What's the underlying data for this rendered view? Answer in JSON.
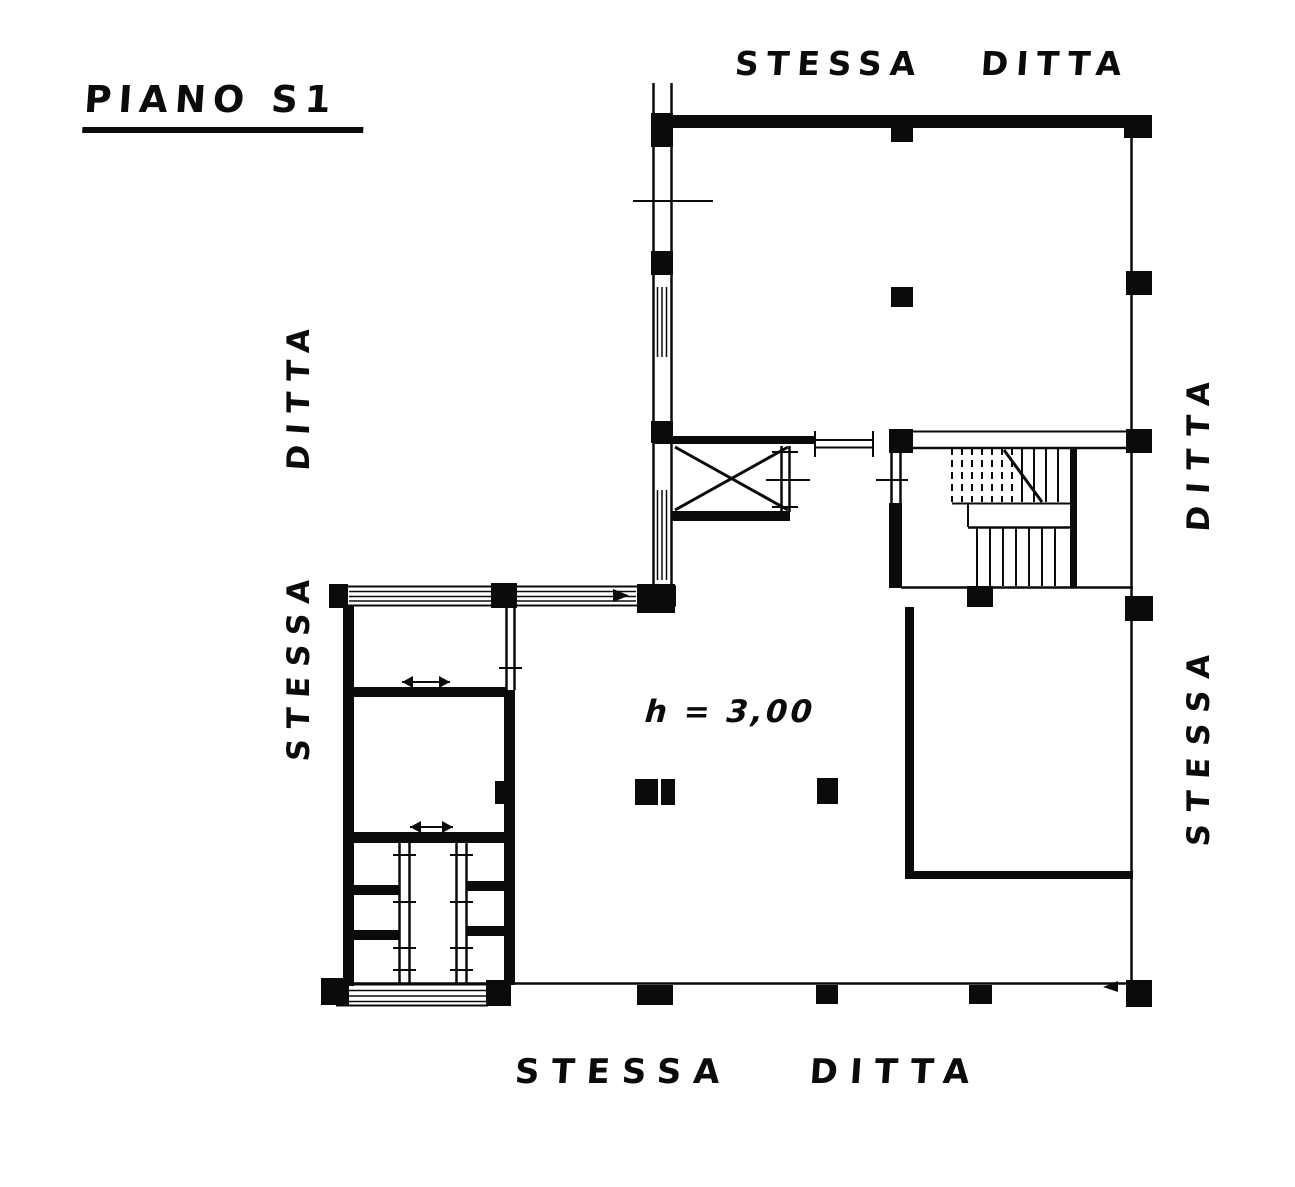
{
  "canvas": {
    "width": 1295,
    "height": 1187,
    "paper_color": "#ffffff",
    "ink_color": "#0b0b0b"
  },
  "title": {
    "label": "PIANO S1"
  },
  "annotations": {
    "top_label": "STESSA DITTA",
    "left_label": "STESSA DITTA",
    "right_label": "STESSA DITTA",
    "bottom_label_word1": "STESSA",
    "bottom_label_word2": "DITTA",
    "ceiling_height_note": "h = 3,00"
  }
}
